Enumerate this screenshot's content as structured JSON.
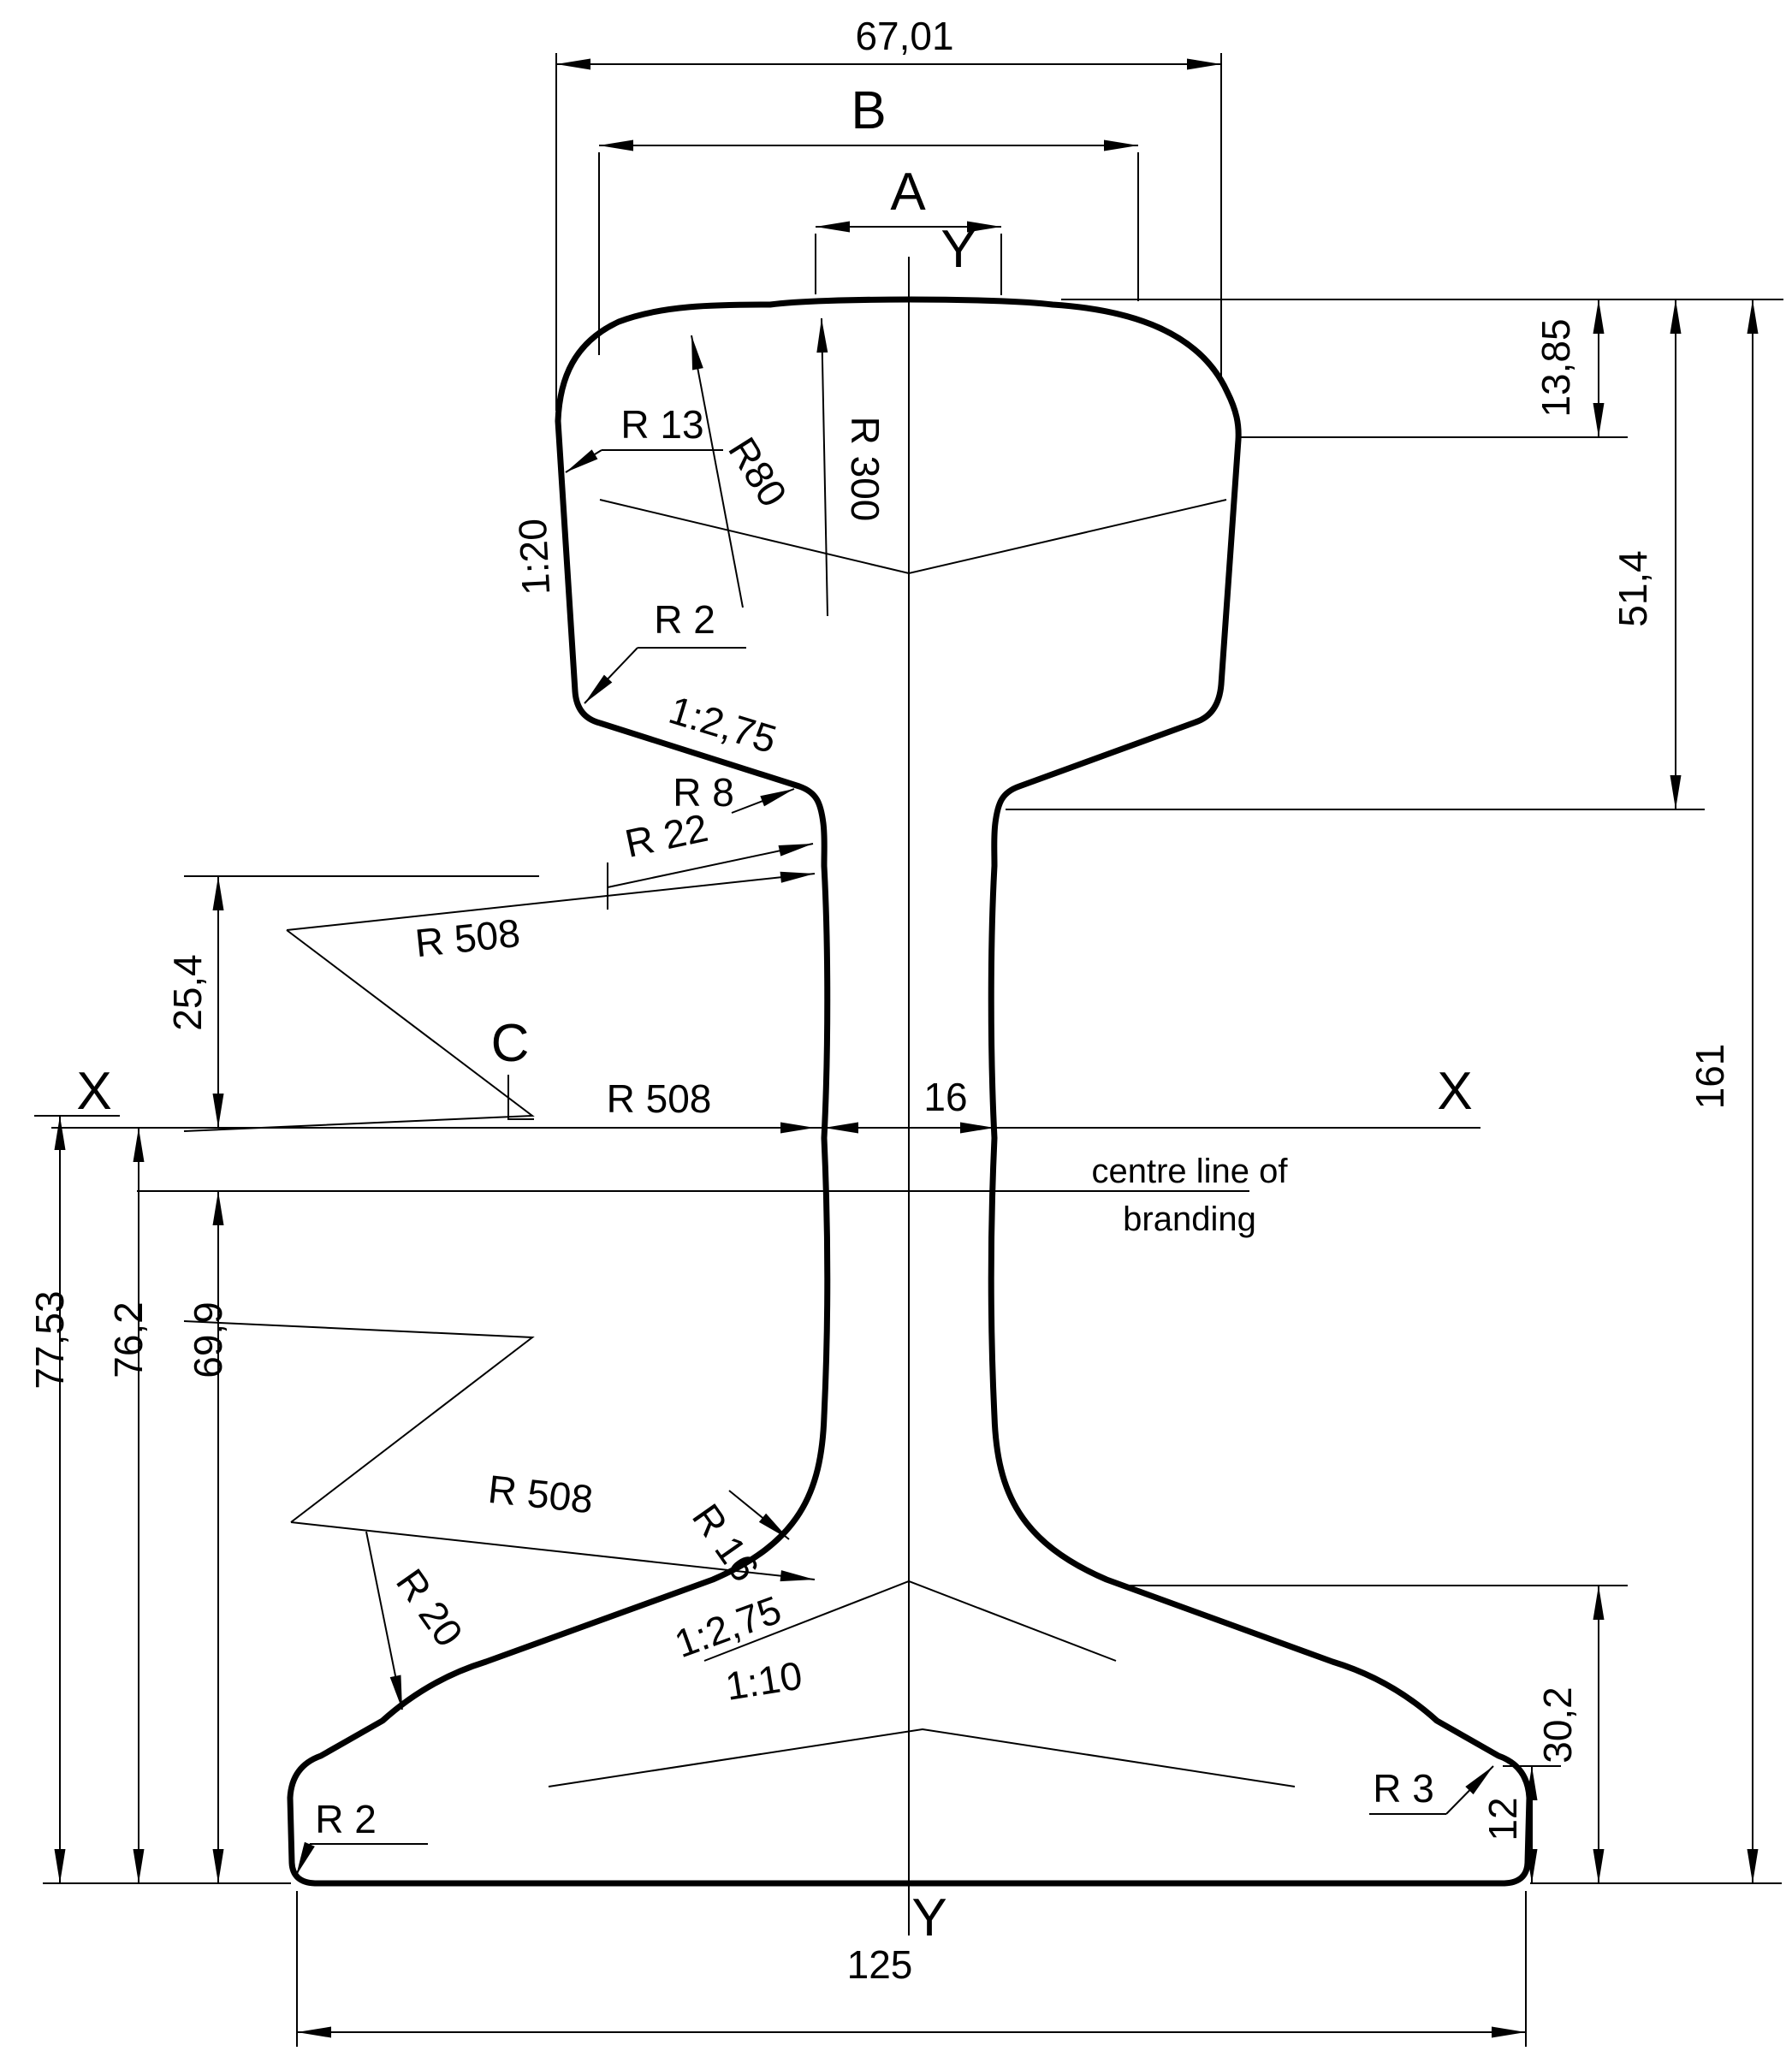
{
  "meta": {
    "drawing_type": "rail cross-section technical drawing",
    "line_color": "#000000",
    "background_color": "#ffffff"
  },
  "labels": {
    "head_width": "67,01",
    "dim_b": "B",
    "dim_a": "A",
    "axis_y_top": "Y",
    "axis_y_bottom": "Y",
    "axis_x_left": "X",
    "axis_x_right": "X",
    "point_c": "C",
    "head_corner_depth": "13,85",
    "head_depth": "51,4",
    "total_height": "161",
    "radius_r13": "R 13",
    "radius_r80": "R80",
    "radius_r300": "R 300",
    "head_side_slope": "1:20",
    "radius_r2_head": "R 2",
    "head_underside_slope": "1:2,75",
    "radius_r8": "R 8",
    "radius_r22": "R 22",
    "radius_r508_upper": "R 508",
    "radius_r508_mid": "R 508",
    "radius_r508_lower": "R 508",
    "upper_web_height": "25,4",
    "web_thickness": "16",
    "branding_line_1": "centre line of",
    "branding_line_2": "branding",
    "height_x_upper": "77,53",
    "height_x_axis": "76,2",
    "height_branding": "69,9",
    "radius_r16": "R 16",
    "radius_r20": "R 20",
    "foot_top_slope": "1:2,75",
    "foot_outer_slope": "1:10",
    "foot_rise": "30,2",
    "foot_edge_thickness": "12",
    "radius_r3": "R 3",
    "radius_r2_foot": "R 2",
    "foot_width": "125"
  }
}
